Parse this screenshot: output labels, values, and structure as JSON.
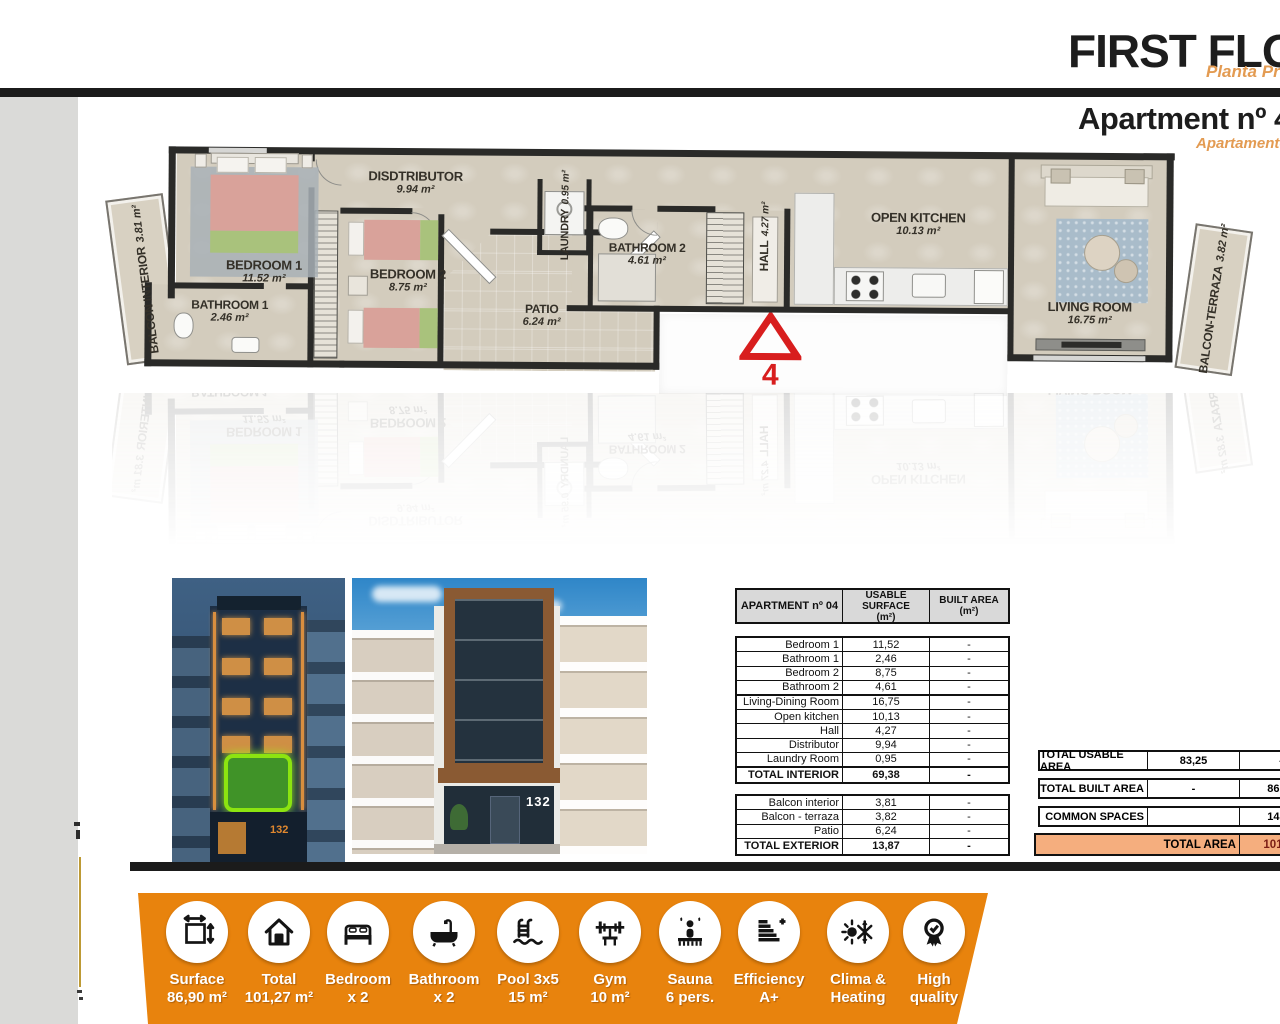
{
  "header": {
    "title": "FIRST FLOOR",
    "subtitle": "Planta Primera",
    "apartment_title": "Apartment nº 4",
    "apartment_subtitle": "Apartamento nº 4"
  },
  "colors": {
    "accent_orange": "#E8830D",
    "subtitle_orange": "#E39B52",
    "total_area_bg": "#F5AE7E",
    "marker_red": "#D81E1E",
    "highlight_green": "#8CE410"
  },
  "floor_plan": {
    "unit_marker": "4",
    "rooms": [
      {
        "name": "BALCON INTERIOR",
        "area": "3.81 m²"
      },
      {
        "name": "BEDROOM 1",
        "area": "11.52 m²"
      },
      {
        "name": "BATHROOM 1",
        "area": "2.46 m²"
      },
      {
        "name": "BEDROOM 2",
        "area": "8.75 m²"
      },
      {
        "name": "DISDTRIBUTOR",
        "area": "9.94 m²"
      },
      {
        "name": "LAUNDRY",
        "area": "0.95 m²"
      },
      {
        "name": "PATIO",
        "area": "6.24 m²"
      },
      {
        "name": "BATHROOM 2",
        "area": "4.61 m²"
      },
      {
        "name": "HALL",
        "area": "4.27 m²"
      },
      {
        "name": "OPEN KITCHEN",
        "area": "10.13 m²"
      },
      {
        "name": "LIVING ROOM",
        "area": "16.75 m²"
      },
      {
        "name": "BALCON-TERRAZA",
        "area": "3.82 m²"
      }
    ]
  },
  "photos": {
    "night_building_number": "132",
    "day_building_number": "132"
  },
  "surface_table": {
    "title": "APARTMENT nº 04",
    "col_usable": "USABLE SURFACE",
    "col_usable_unit": "(m²)",
    "col_built": "BUILT AREA",
    "col_built_unit": "(m²)",
    "interior_rows": [
      {
        "label": "Bedroom 1",
        "usable": "11,52",
        "built": "-"
      },
      {
        "label": "Bathroom 1",
        "usable": "2,46",
        "built": "-"
      },
      {
        "label": "Bedroom 2",
        "usable": "8,75",
        "built": "-"
      },
      {
        "label": "Bathroom 2",
        "usable": "4,61",
        "built": "-"
      },
      {
        "label": "Living-Dining Room",
        "usable": "16,75",
        "built": "-"
      },
      {
        "label": "Open kitchen",
        "usable": "10,13",
        "built": "-"
      },
      {
        "label": "Hall",
        "usable": "4,27",
        "built": "-"
      },
      {
        "label": "Distributor",
        "usable": "9,94",
        "built": "-"
      },
      {
        "label": "Laundry Room",
        "usable": "0,95",
        "built": "-"
      },
      {
        "label": "TOTAL INTERIOR",
        "usable": "69,38",
        "built": "-"
      }
    ],
    "exterior_rows": [
      {
        "label": "Balcon interior",
        "usable": "3,81",
        "built": "-"
      },
      {
        "label": "Balcon - terraza",
        "usable": "3,82",
        "built": "-"
      },
      {
        "label": "Patio",
        "usable": "6,24",
        "built": "-"
      },
      {
        "label": "TOTAL EXTERIOR",
        "usable": "13,87",
        "built": "-"
      }
    ]
  },
  "totals": {
    "rows": [
      {
        "label": "TOTAL USABLE AREA",
        "usable": "83,25",
        "built": "-"
      },
      {
        "label": "TOTAL BUILT AREA",
        "usable": "-",
        "built": "86,90"
      },
      {
        "label": "COMMON SPACES",
        "usable": "",
        "built": "14,37"
      }
    ],
    "total_area_label": "TOTAL AREA",
    "total_area_value": "101,27"
  },
  "amenities": [
    {
      "icon": "surface",
      "line1": "Surface",
      "line2": "86,90 m²"
    },
    {
      "icon": "house",
      "line1": "Total",
      "line2": "101,27 m²"
    },
    {
      "icon": "bed",
      "line1": "Bedroom",
      "line2": "x 2"
    },
    {
      "icon": "bath",
      "line1": "Bathroom",
      "line2": "x 2"
    },
    {
      "icon": "pool",
      "line1": "Pool 3x5",
      "line2": "15 m²"
    },
    {
      "icon": "gym",
      "line1": "Gym",
      "line2": "10 m²"
    },
    {
      "icon": "sauna",
      "line1": "Sauna",
      "line2": "6 pers."
    },
    {
      "icon": "efficiency",
      "line1": "Efficiency",
      "line2": "A+"
    },
    {
      "icon": "clima",
      "line1": "Clima &",
      "line2": "Heating"
    },
    {
      "icon": "quality",
      "line1": "High",
      "line2": "quality"
    }
  ]
}
